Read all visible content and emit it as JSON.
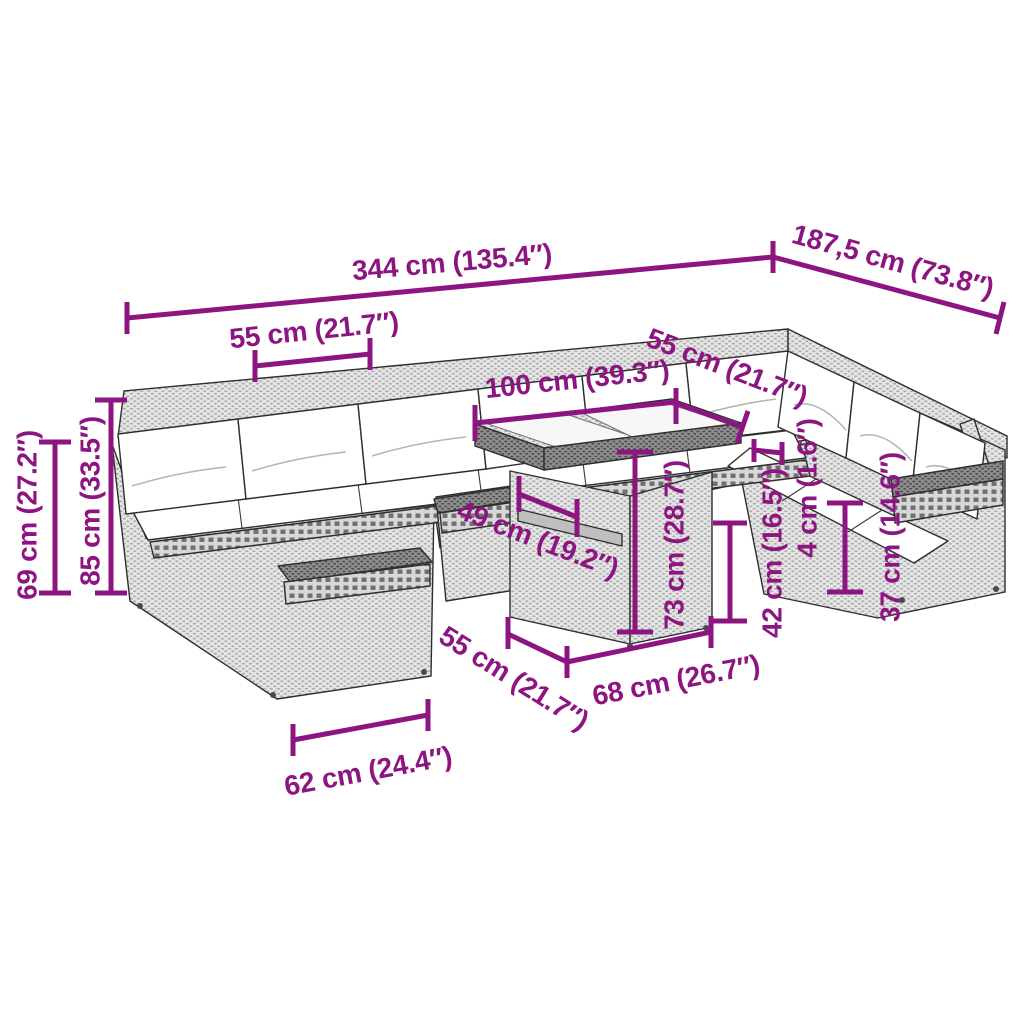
{
  "diagram": {
    "kind": "product-dimension-diagram",
    "subject": "rattan garden lounge set with cushions and glass-top table",
    "accent_color": "#8C1581",
    "outline_color": "#2e2e2e",
    "wicker_color": "#e6e6e6",
    "cushion_color": "#ffffff",
    "background_color": "#ffffff",
    "dimensions": [
      {
        "id": "overall_width",
        "label": "344 cm (135.4″)"
      },
      {
        "id": "overall_depth",
        "label": "187,5 cm (73.8″)"
      },
      {
        "id": "seat_module_width_left",
        "label": "55 cm (21.7″)"
      },
      {
        "id": "table_top_length",
        "label": "100 cm (39.3″)"
      },
      {
        "id": "seat_module_width_right",
        "label": "55 cm (21.7″)"
      },
      {
        "id": "depth_49",
        "label": "49 cm (19.2″)"
      },
      {
        "id": "table_height",
        "label": "73 cm (28.7″)"
      },
      {
        "id": "table_top_thickness",
        "label": "4 cm (1.6″)"
      },
      {
        "id": "height_42",
        "label": "42 cm (16.5″)"
      },
      {
        "id": "height_37",
        "label": "37 cm (14.6″)"
      },
      {
        "id": "height_69",
        "label": "69 cm (27.2″)"
      },
      {
        "id": "height_85",
        "label": "85 cm (33.5″)"
      },
      {
        "id": "table_base_depth",
        "label": "55 cm (21.7″)"
      },
      {
        "id": "table_base_width",
        "label": "68 cm (26.7″)"
      },
      {
        "id": "module_width_62",
        "label": "62 cm (24.4″)"
      }
    ]
  }
}
